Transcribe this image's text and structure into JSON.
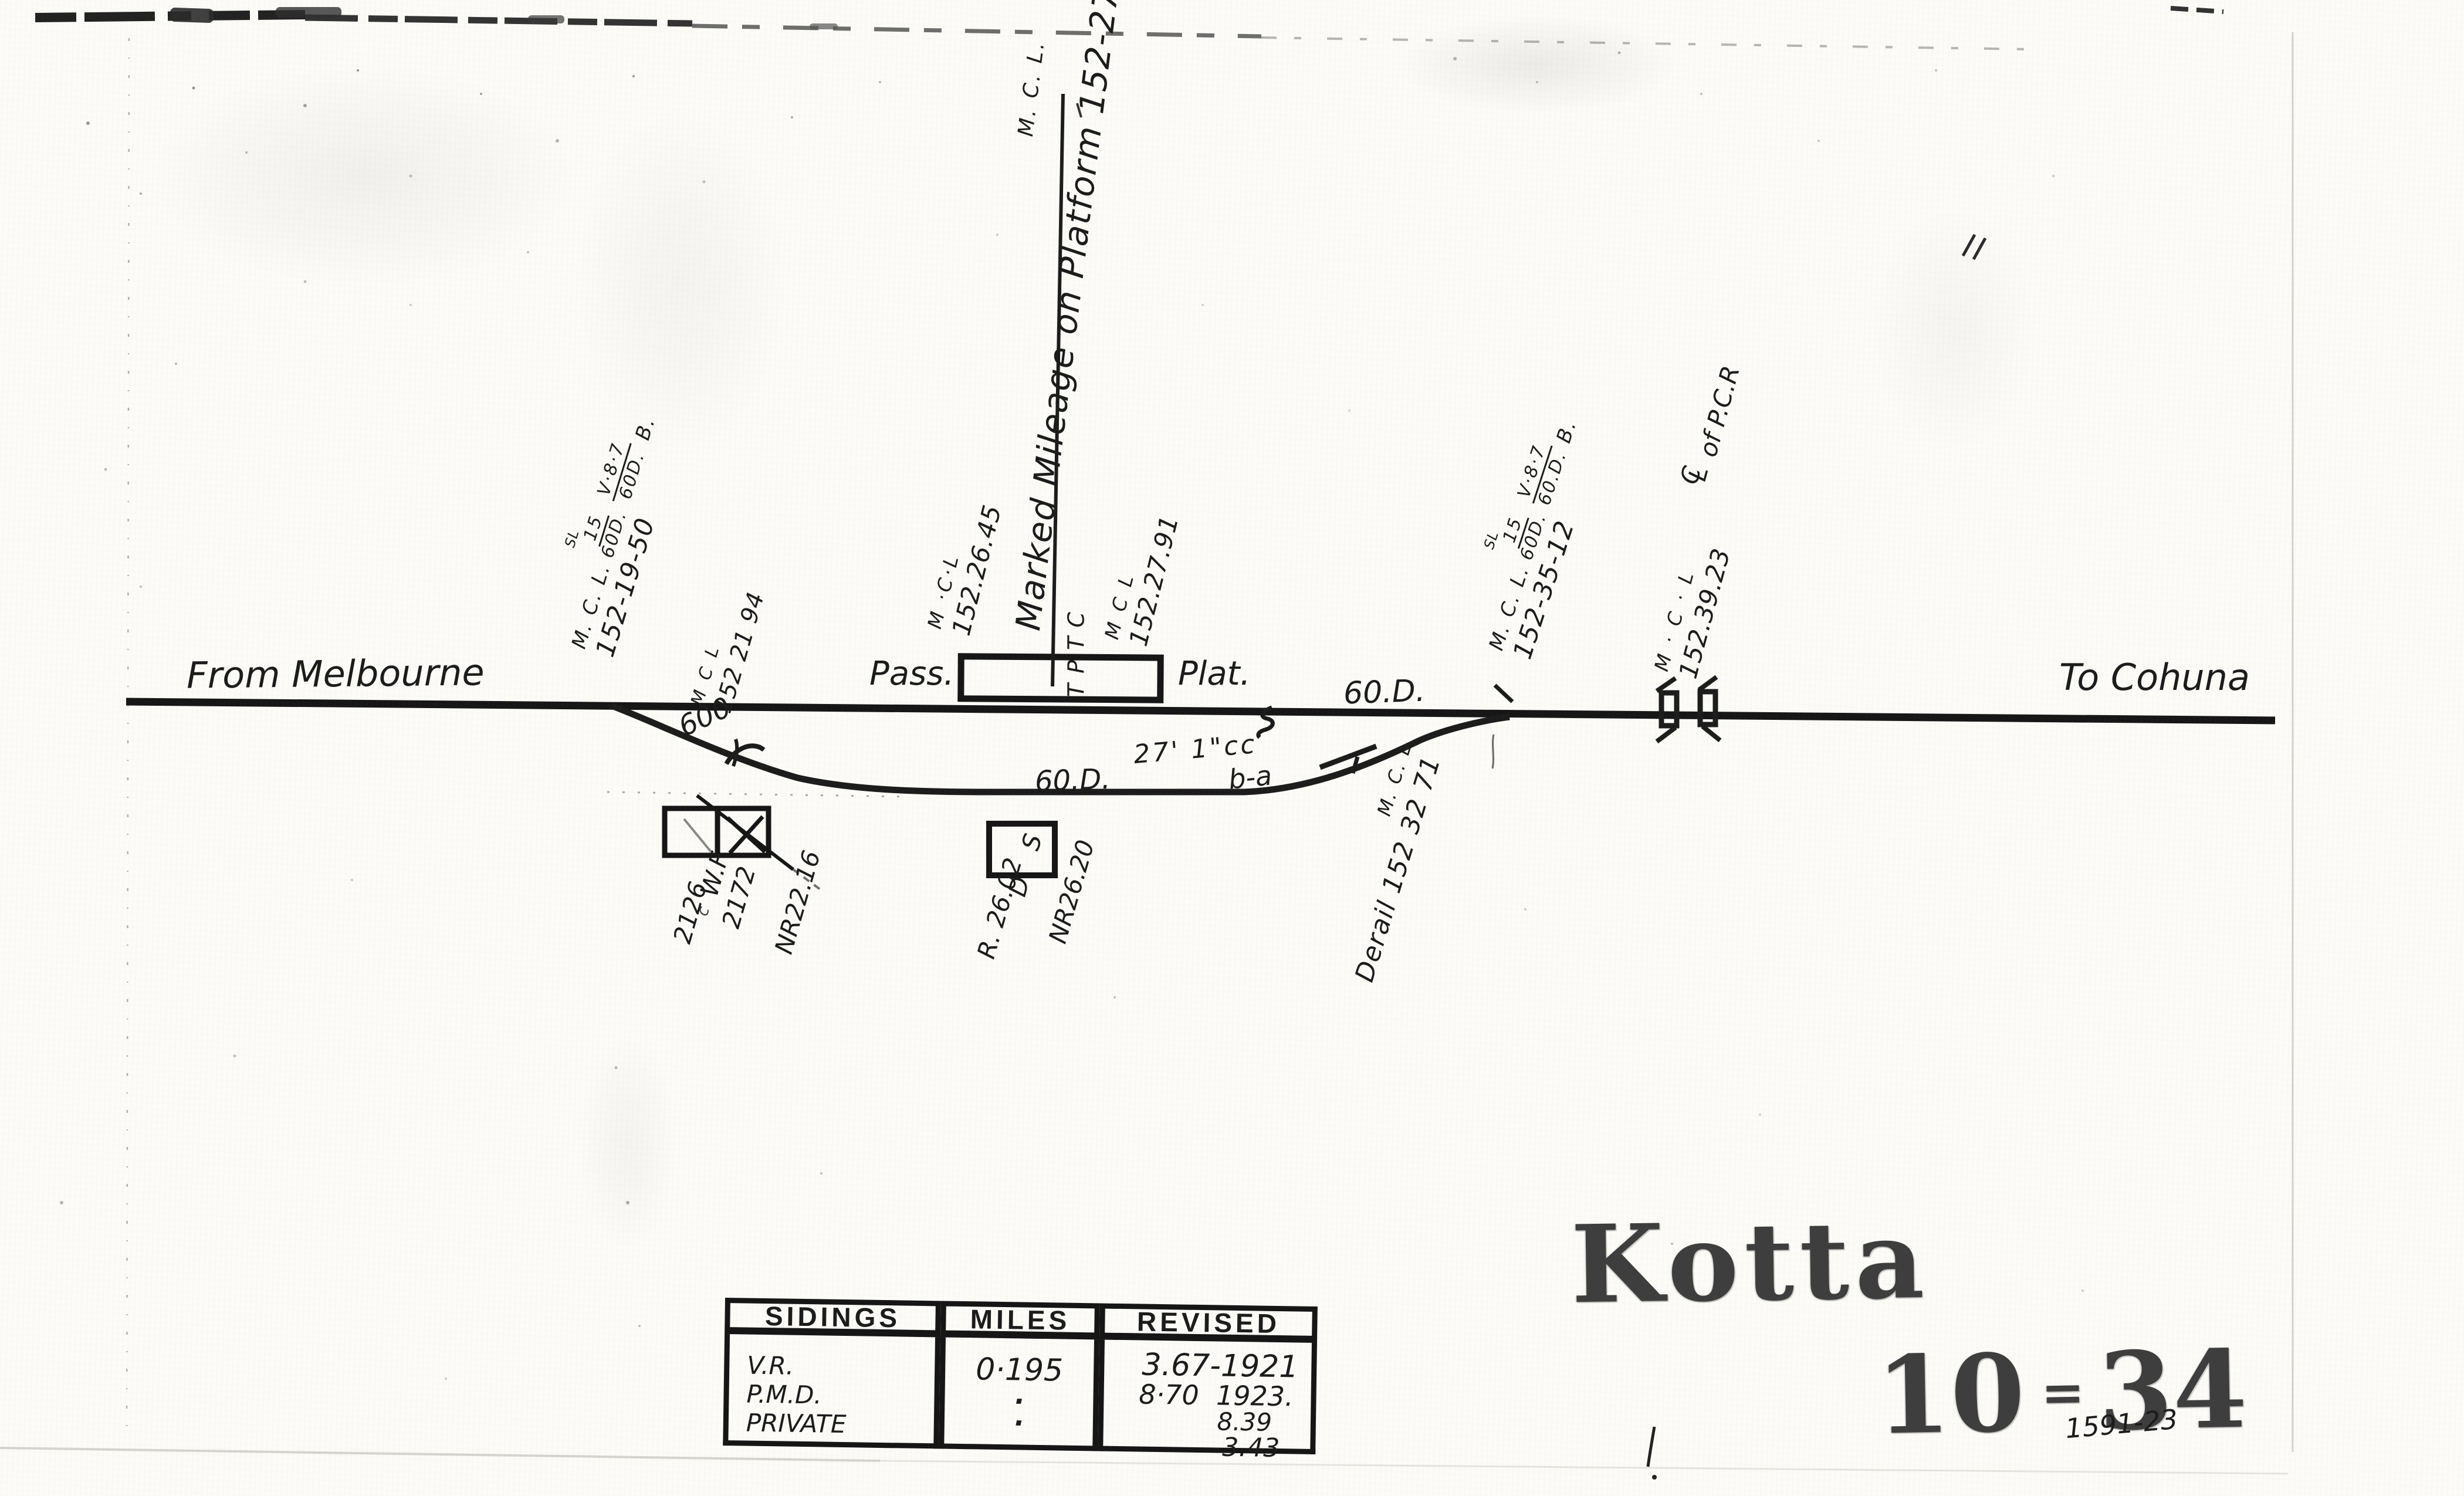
{
  "palette": {
    "ink": "#1c1c1c",
    "stamp": "#3e3e3e",
    "paper": "#fcfbf8"
  },
  "directions": {
    "from": "From Melbourne",
    "to": "To Cohuna"
  },
  "track": {
    "pass_label": "Pass.",
    "plat_label": "Plat.",
    "platform_code": "TPTC",
    "platform_code_letters": [
      "C",
      "T",
      "P",
      "T"
    ],
    "marked_mileage_text": "Marked Mileage on Platform 152-27-21",
    "marked_mileage_unit": "M. C. L.",
    "main_grade": "60.D.",
    "loop_grade": "60.D.",
    "track_centres": "27' 1\"cc",
    "levers": "b-a",
    "curve_radius": "600"
  },
  "mileages": {
    "left_cluster": {
      "unit": "M. C. L.",
      "sl": "SL",
      "frac1_top": "15",
      "frac1_bot": "60D.",
      "frac2_top": "V·8·7",
      "frac2_bot": "60D.",
      "tail": "B.",
      "value": "152-19-50"
    },
    "right_cluster": {
      "unit": "M. C. L.",
      "sl": "SL",
      "frac1_top": "15",
      "frac1_bot": "60D.",
      "frac2_top": "V·8·7",
      "frac2_bot": "60.D.",
      "tail": "B.",
      "value": "152-35-12"
    },
    "platform_left": {
      "unit": "M ·C·L",
      "value": "152.26.45"
    },
    "platform_right": {
      "unit": "M C L",
      "value": "152.27.91"
    },
    "turnout": {
      "unit": "M C L",
      "value": "152 21 94"
    },
    "crossing": {
      "unit": "M · C · L",
      "value": "152.39.23"
    },
    "crossing_centreline": {
      "c": "C",
      "l": "L",
      "rest": "of P.C.R"
    },
    "derail": {
      "unit": "M. C. L",
      "value": "Derail 152 32 71"
    }
  },
  "buildings": {
    "goods": {
      "label": "W.F",
      "dim1": "2126",
      "dim2": "2172",
      "nr": "NR22.16",
      "stray": "c"
    },
    "shelter": {
      "label": "D S",
      "r": "R. 26.02",
      "nr": "NR26.20"
    }
  },
  "sidings_table": {
    "headers": [
      "SIDINGS",
      "MILES",
      "REVISED"
    ],
    "rows": [
      {
        "siding": "V.R.",
        "miles": "0·195"
      },
      {
        "siding": "P.M.D.",
        "miles": "·"
      },
      {
        "siding": "PRIVATE",
        "miles": "·"
      }
    ],
    "revised_lines": [
      "3.67-1921",
      "8·70  1923.",
      "8.39",
      "3.43"
    ]
  },
  "title": {
    "station": "Kotta",
    "plate_left": "10",
    "plate_sep": "=",
    "plate_right": "34",
    "drawing_no": "1591-23"
  }
}
